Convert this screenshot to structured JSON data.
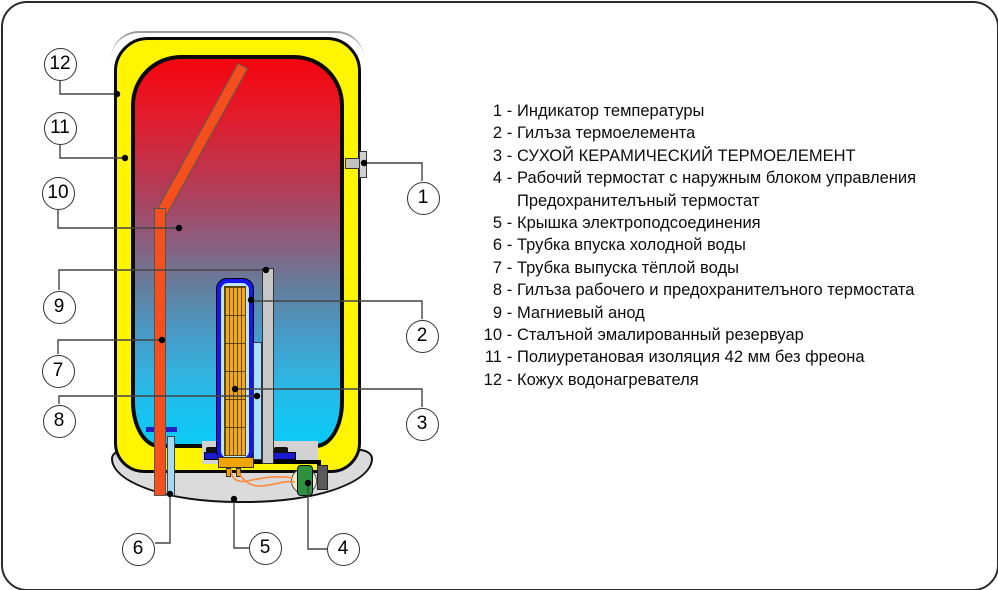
{
  "callouts": [
    {
      "label": "1"
    },
    {
      "label": "2"
    },
    {
      "label": "3"
    },
    {
      "label": "4"
    },
    {
      "label": "5"
    },
    {
      "label": "6"
    },
    {
      "label": "7"
    },
    {
      "label": "8"
    },
    {
      "label": "9"
    },
    {
      "label": "10"
    },
    {
      "label": "11"
    },
    {
      "label": "12"
    }
  ],
  "legend": {
    "items": [
      {
        "num": "1",
        "sep": "-",
        "text": "Индикатор температуры"
      },
      {
        "num": "2",
        "sep": "-",
        "text": "Гилъза термоелемента"
      },
      {
        "num": "3",
        "sep": "-",
        "text": "СУХОЙ КЕРАМИЧЕСКИЙ ТЕРМОЕЛЕМЕНТ"
      },
      {
        "num": "4",
        "sep": "-",
        "text": "Рабочий термостат с наружным блоком управления"
      },
      {
        "num": "",
        "sep": "",
        "text": "Предохранителъный термостат"
      },
      {
        "num": "5",
        "sep": "-",
        "text": "Крышка электроподсоединения"
      },
      {
        "num": "6",
        "sep": "-",
        "text": "Трубка впуска холодной воды"
      },
      {
        "num": "7",
        "sep": "-",
        "text": "Трубка выпуска тёплой воды"
      },
      {
        "num": "8",
        "sep": "-",
        "text": "Гилъза рабочего и предохранителъного термостата"
      },
      {
        "num": "9",
        "sep": "-",
        "text": "Магниевый анод"
      },
      {
        "num": "10",
        "sep": "-",
        "text": "Сталъной эмалированный резервуар"
      },
      {
        "num": "11",
        "sep": "-",
        "text": "Полиуретановая изоляция 42 мм без фреона"
      },
      {
        "num": "12",
        "sep": "-",
        "text": "Кожух водонагревателя"
      }
    ]
  },
  "colors": {
    "casing_yellow": "#FFF500",
    "tank_hot_red": "#E51A2A",
    "tank_cold_cyan": "#0DC9F6",
    "element_sleeve_blue": "#1616EE",
    "element_ceramic_yellow": "#F2A71E",
    "hot_pipe_orange": "#F44F1C",
    "inlet_pipe_blue": "#A6D9F2",
    "anode_gray": "#C8C8C8",
    "thermostat_green": "#2E9140",
    "cover_gray": "#DBDBDB"
  }
}
